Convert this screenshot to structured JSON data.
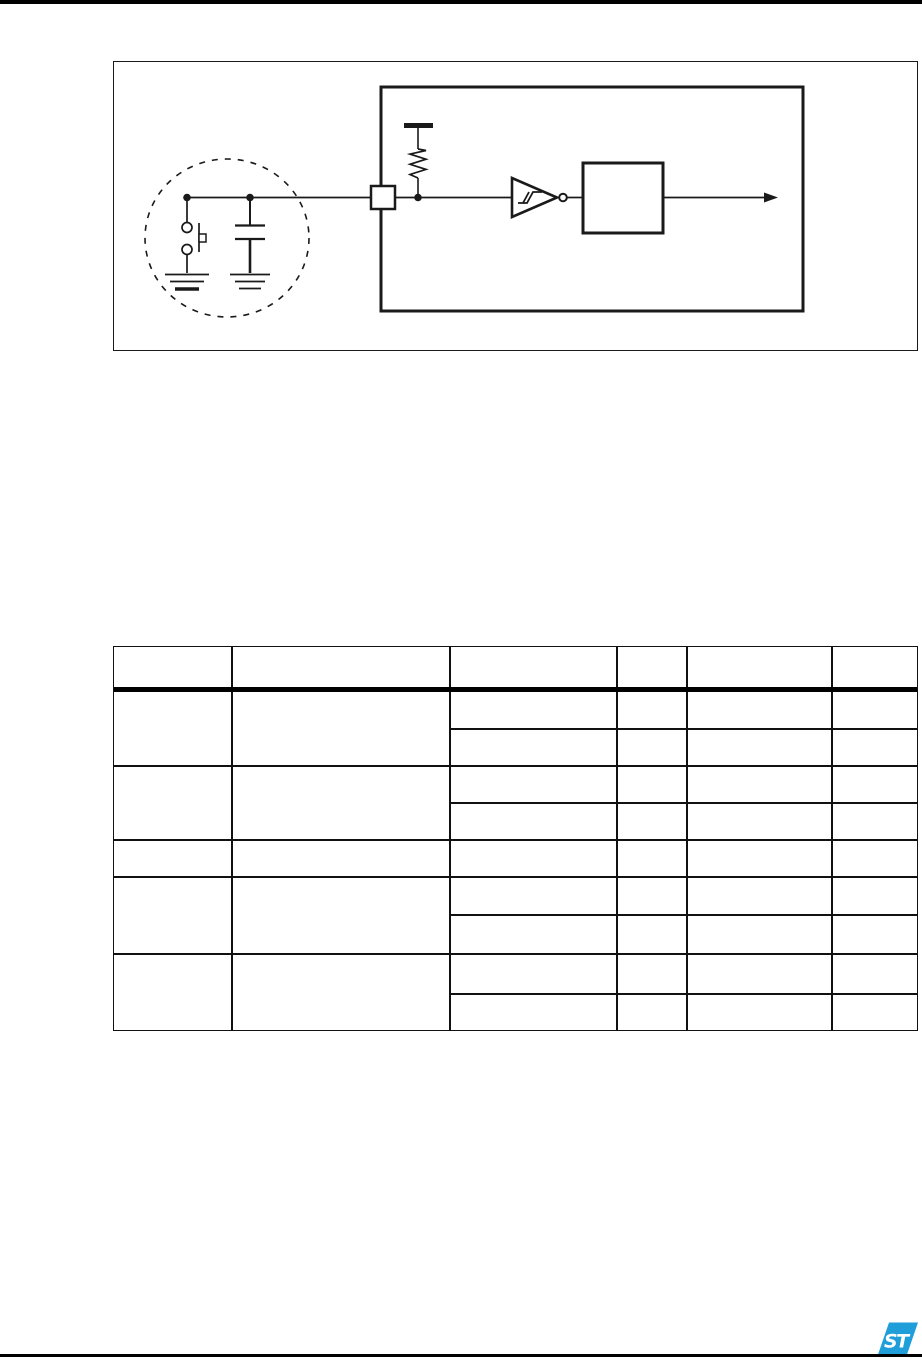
{
  "page": {
    "kind": "datasheet-page-fragment",
    "background": "#ffffff",
    "ink": "#1a1a1a",
    "visible_text": []
  },
  "figure": {
    "description": "reset-pin schematic: dashed circle with push-button and capacitor to ground, pad into chip boundary, internal pull-up resistor to VDD rail, schmitt-trigger inverter, filter block, output arrow",
    "components": [
      "external-network-dashed-circle",
      "push-button-switch",
      "capacitor",
      "ground-symbol-left",
      "ground-symbol-right",
      "io-pad-square",
      "chip-boundary-box",
      "pull-up-resistor",
      "vdd-rail-bar",
      "schmitt-trigger-inverter",
      "filter-block-box",
      "output-arrow"
    ],
    "labels_visible": "none"
  },
  "table": {
    "columns": 6,
    "header_rows": 1,
    "body_row_groups": 5,
    "row_groups_with_two_subrows": [
      1,
      2,
      4,
      5
    ],
    "cells_text": "all cells empty (no rendered text)"
  },
  "footer": {
    "logo_monogram": "ST",
    "logo_color": "#1F9ED9",
    "rule_color": "#000000"
  }
}
